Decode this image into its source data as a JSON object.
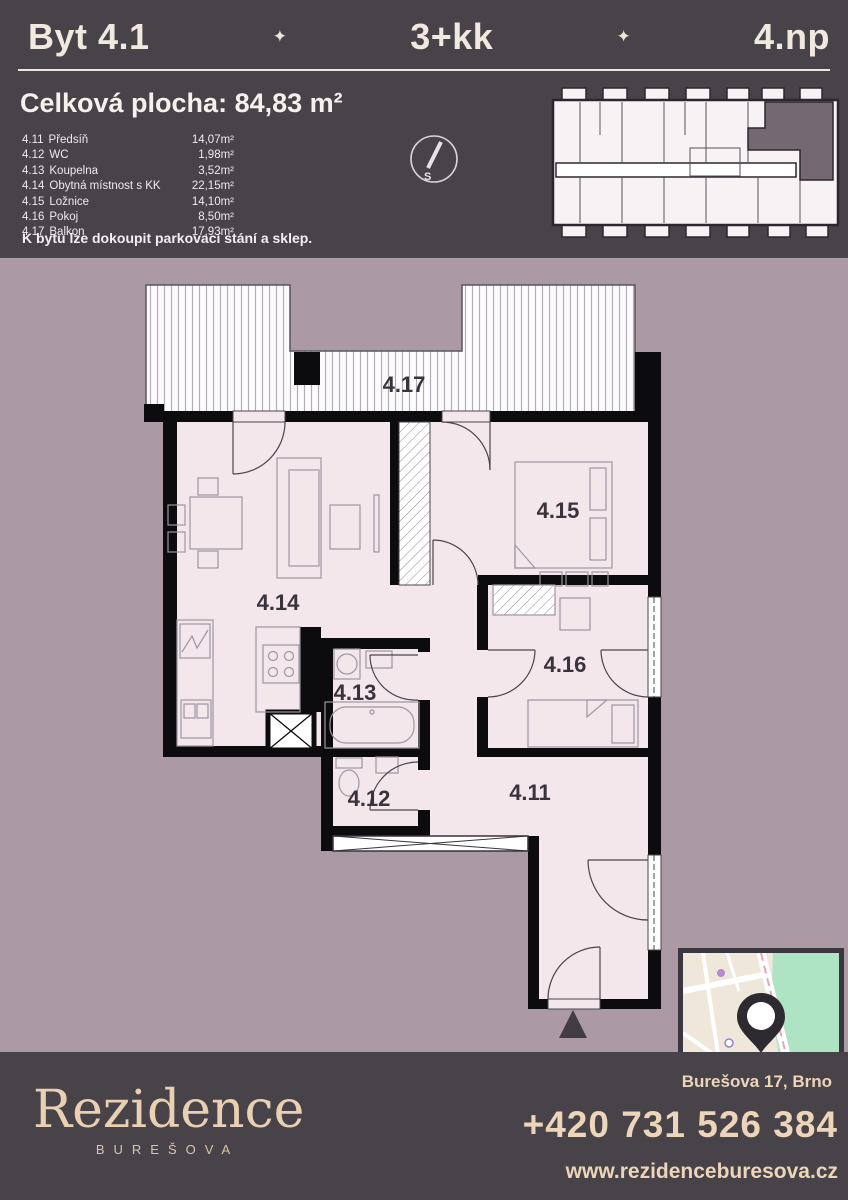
{
  "colors": {
    "panel_dark": "#474349",
    "background_mauve": "#ab9aa3",
    "room_fill": "#f3e7ec",
    "wall_black": "#0c0b0d",
    "cream_text": "#ecd5b9",
    "highlight_unit": "#746871",
    "map_park_green": "#aee3c4"
  },
  "header": {
    "unit": "Byt 4.1",
    "divider_icon": "✦",
    "layout": "3+kk",
    "floor": "4.np"
  },
  "summary": {
    "total": "Celková plocha: 84,83 m²",
    "rooms": [
      {
        "id": "4.11",
        "name": "Předsíň",
        "area": "14,07m²"
      },
      {
        "id": "4.12",
        "name": "WC",
        "area": "1,98m²"
      },
      {
        "id": "4.13",
        "name": "Koupelna",
        "area": "3,52m²"
      },
      {
        "id": "4.14",
        "name": "Obytná místnost s KK",
        "area": "22,15m²"
      },
      {
        "id": "4.15",
        "name": "Ložnice",
        "area": "14,10m²"
      },
      {
        "id": "4.16",
        "name": "Pokoj",
        "area": "8,50m²"
      },
      {
        "id": "4.17",
        "name": "Balkon",
        "area": "17,93m²"
      }
    ],
    "note": "K bytu lze dokoupit parkovací stání a sklep."
  },
  "compass": {
    "letter": "S"
  },
  "plan": {
    "labels": {
      "r411": "4.11",
      "r412": "4.12",
      "r413": "4.13",
      "r414": "4.14",
      "r415": "4.15",
      "r416": "4.16",
      "r417": "4.17"
    }
  },
  "footer": {
    "brand": "Rezidence",
    "brand_sub": "BUREŠOVA",
    "address": "Burešova 17, Brno",
    "phone": "+420 731 526 384",
    "web": "www.rezidenceburesova.cz"
  }
}
